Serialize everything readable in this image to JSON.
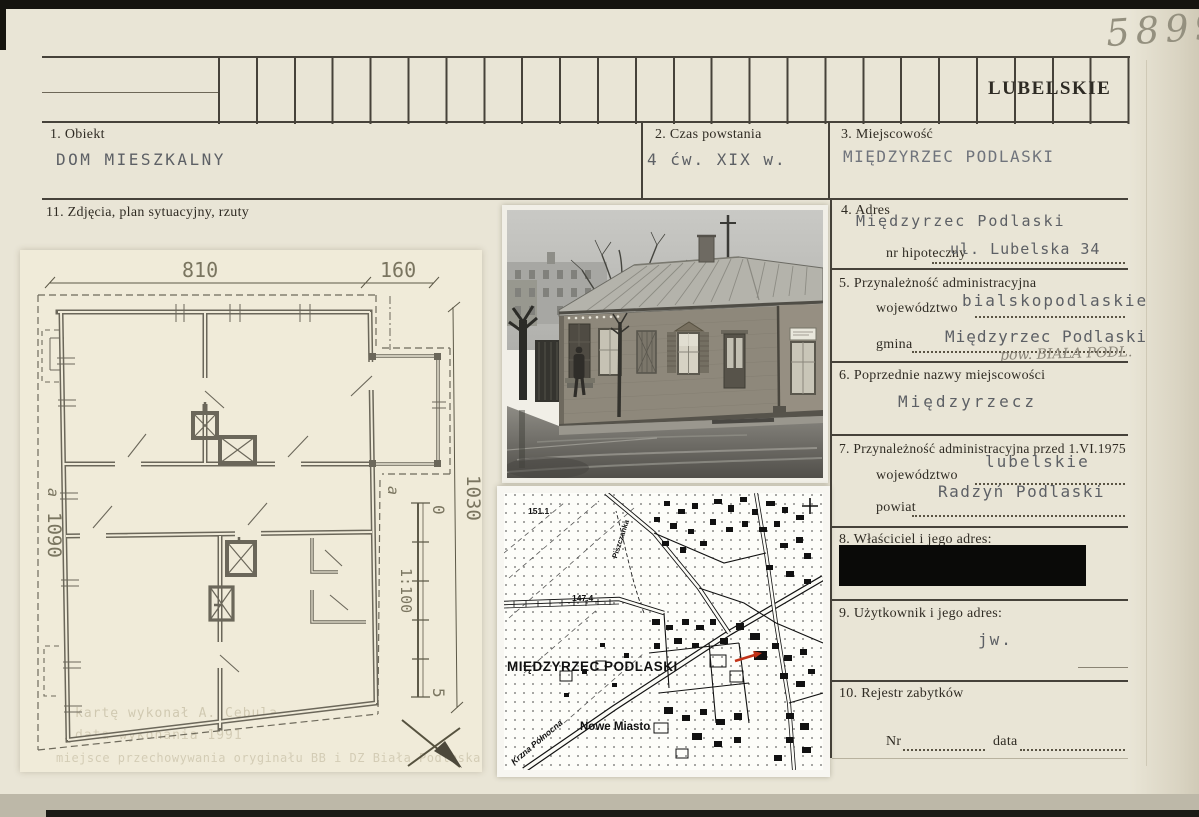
{
  "card": {
    "inventory_number": "5899",
    "voivodeship_stamp": "LUBELSKIE",
    "fields": {
      "obiekt": {
        "label": "1. Obiekt",
        "value": "DOM MIESZKALNY"
      },
      "czas": {
        "label": "2. Czas powstania",
        "value": "4 ćw. XIX w."
      },
      "miejscowosc": {
        "label": "3. Miejscowość",
        "value": "MIĘDZYRZEC PODLASKI"
      },
      "adres": {
        "label": "4. Adres",
        "value": "Międzyrzec Podlaski",
        "hipoteczny_label": "nr hipoteczny",
        "hipoteczny_value": "ul. Lubelska 34"
      },
      "przynaleznosc": {
        "label": "5. Przynależność administracyjna",
        "wojewodztwo_label": "województwo",
        "wojewodztwo_value": "bialskopodlaskie",
        "gmina_label": "gmina",
        "gmina_value": "Międzyrzec Podlaski",
        "pencil_note": "pow. BIAŁA PODL."
      },
      "poprzednie": {
        "label": "6. Poprzednie nazwy miejscowości",
        "value": "Międzyrzecz"
      },
      "przed1975": {
        "label": "7. Przynależność administracyjna przed 1.VI.1975",
        "wojewodztwo_label": "województwo",
        "wojewodztwo_value": "lubelskie",
        "powiat_label": "powiat",
        "powiat_value": "Radzyń Podlaski"
      },
      "wlasciciel": {
        "label": "8. Właściciel i jego adres:"
      },
      "uzytkownik": {
        "label": "9. Użytkownik i jego adres:",
        "value": "jw."
      },
      "rejestr": {
        "label": "10. Rejestr zabytków",
        "nr_label": "Nr",
        "data_label": "data"
      },
      "zdjecia": {
        "label": "11. Zdjęcia, plan sytuacyjny, rzuty"
      }
    },
    "plan": {
      "dim_width_main": "810",
      "dim_width_annex": "160",
      "dim_height_right": "1030",
      "dim_height_left": "1090",
      "section_marker_left": "a",
      "section_marker_right": "a",
      "scale_label": "1:100",
      "scale_start": "0",
      "scale_end": "5",
      "ghost_note_1": "kartę wykonał   A. Cebula",
      "ghost_note_2": "data wykonania        1991",
      "ghost_note_3": "miejsce przechowywania oryginału   BB i DZ Biała Podlaska"
    },
    "map": {
      "title": "MIĘDZYRZEC PODLASKI",
      "district_label": "Nowe Miasto",
      "river_label": "Krzna Północna",
      "stream_label": "Piszczanka",
      "elevation_1": "151.1",
      "elevation_2": "147.4",
      "marker_color": "#c23318"
    }
  }
}
